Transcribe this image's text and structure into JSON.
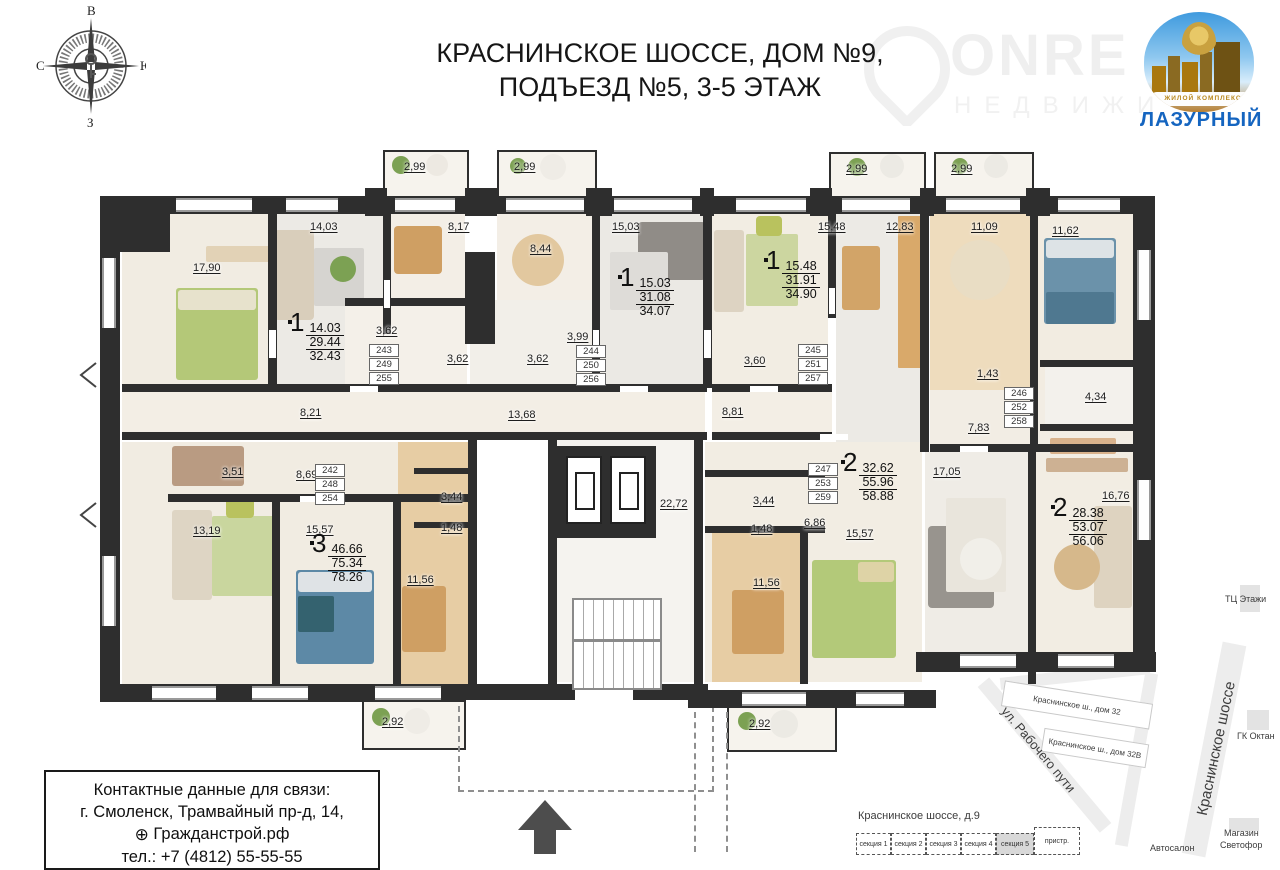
{
  "title": {
    "line1": "КРАСНИНСКОЕ ШОССЕ, ДОМ №9,",
    "line2": "ПОДЪЕЗД №5, 3-5 ЭТАЖ"
  },
  "compass": {
    "top": "В",
    "right": "Ю",
    "bottom": "З",
    "left": "С"
  },
  "branding": {
    "watermark_name": "ONRE",
    "watermark_sub": "НЕДВИЖИ",
    "complex_type": "ЖИЛОЙ КОМПЛЕКС",
    "complex_name": "ЛАЗУРНЫЙ"
  },
  "floorplan": {
    "room_labels": [
      {
        "text": "2,99",
        "x": 404,
        "y": 161
      },
      {
        "text": "2,99",
        "x": 514,
        "y": 161
      },
      {
        "text": "2,99",
        "x": 846,
        "y": 163
      },
      {
        "text": "2,99",
        "x": 951,
        "y": 163
      },
      {
        "text": "17,90",
        "x": 193,
        "y": 262
      },
      {
        "text": "14,03",
        "x": 310,
        "y": 221
      },
      {
        "text": "8,17",
        "x": 448,
        "y": 221
      },
      {
        "text": "8,44",
        "x": 530,
        "y": 243
      },
      {
        "text": "15,03",
        "x": 612,
        "y": 221
      },
      {
        "text": "15,48",
        "x": 818,
        "y": 221
      },
      {
        "text": "12,83",
        "x": 886,
        "y": 221
      },
      {
        "text": "11,09",
        "x": 971,
        "y": 221
      },
      {
        "text": "11,62",
        "x": 1052,
        "y": 225
      },
      {
        "text": "3,62",
        "x": 376,
        "y": 325
      },
      {
        "text": "3,62",
        "x": 447,
        "y": 353
      },
      {
        "text": "3,99",
        "x": 567,
        "y": 331
      },
      {
        "text": "3,62",
        "x": 527,
        "y": 353
      },
      {
        "text": "3,60",
        "x": 744,
        "y": 355
      },
      {
        "text": "1,43",
        "x": 977,
        "y": 368
      },
      {
        "text": "4,34",
        "x": 1085,
        "y": 391
      },
      {
        "text": "8,21",
        "x": 300,
        "y": 407
      },
      {
        "text": "13,68",
        "x": 508,
        "y": 409
      },
      {
        "text": "8,81",
        "x": 722,
        "y": 406
      },
      {
        "text": "7,83",
        "x": 968,
        "y": 422
      },
      {
        "text": "3,51",
        "x": 222,
        "y": 466
      },
      {
        "text": "8,69",
        "x": 296,
        "y": 469
      },
      {
        "text": "3,44",
        "x": 441,
        "y": 491
      },
      {
        "text": "1,48",
        "x": 441,
        "y": 522
      },
      {
        "text": "13,19",
        "x": 193,
        "y": 525
      },
      {
        "text": "15,57",
        "x": 306,
        "y": 524
      },
      {
        "text": "11,56",
        "x": 407,
        "y": 574
      },
      {
        "text": "22,72",
        "x": 660,
        "y": 498
      },
      {
        "text": "3,44",
        "x": 753,
        "y": 495
      },
      {
        "text": "1,48",
        "x": 751,
        "y": 523
      },
      {
        "text": "6,86",
        "x": 804,
        "y": 517
      },
      {
        "text": "11,56",
        "x": 753,
        "y": 577
      },
      {
        "text": "15,57",
        "x": 846,
        "y": 528
      },
      {
        "text": "17,05",
        "x": 933,
        "y": 466
      },
      {
        "text": "16,76",
        "x": 1102,
        "y": 490
      },
      {
        "text": "2,92",
        "x": 382,
        "y": 716
      },
      {
        "text": "2,92",
        "x": 749,
        "y": 718
      }
    ],
    "unit_stacks": [
      {
        "values": [
          "243",
          "249",
          "255"
        ],
        "x": 369,
        "y": 344
      },
      {
        "values": [
          "244",
          "250",
          "256"
        ],
        "x": 576,
        "y": 345
      },
      {
        "values": [
          "245",
          "251",
          "257"
        ],
        "x": 798,
        "y": 344
      },
      {
        "values": [
          "246",
          "252",
          "258"
        ],
        "x": 1004,
        "y": 387
      },
      {
        "values": [
          "242",
          "248",
          "254"
        ],
        "x": 315,
        "y": 464
      },
      {
        "values": [
          "247",
          "253",
          "259"
        ],
        "x": 808,
        "y": 463
      }
    ],
    "apartments": [
      {
        "type": "1",
        "areas": [
          "14.03",
          "29.44",
          "32.43"
        ],
        "x": 288,
        "y": 320
      },
      {
        "type": "1",
        "areas": [
          "15.03",
          "31.08",
          "34.07"
        ],
        "x": 618,
        "y": 275
      },
      {
        "type": "1",
        "areas": [
          "15.48",
          "31.91",
          "34.90"
        ],
        "x": 764,
        "y": 258
      },
      {
        "type": "2",
        "areas": [
          "32.62",
          "55.96",
          "58.88"
        ],
        "x": 841,
        "y": 460
      },
      {
        "type": "2",
        "areas": [
          "28.38",
          "53.07",
          "56.06"
        ],
        "x": 1051,
        "y": 505
      },
      {
        "type": "3",
        "areas": [
          "46.66",
          "75.34",
          "78.26"
        ],
        "x": 310,
        "y": 541
      }
    ]
  },
  "contact": {
    "line1": "Контактные данные для связи:",
    "line2": "г. Смоленск, Трамвайный пр-д, 14,",
    "site": "Гражданстрой.рф",
    "phone": "тел.: +7 (4812) 55-55-55"
  },
  "map": {
    "labels": [
      {
        "text": "ул. Рабочего пути",
        "x": 985,
        "y": 742,
        "rot": 50,
        "size": 13,
        "bold": false
      },
      {
        "text": "Краснинское шоссе",
        "x": 1148,
        "y": 740,
        "rot": -78,
        "size": 15,
        "bold": false
      },
      {
        "text": "ГК Октан",
        "x": 1237,
        "y": 731,
        "rot": 0,
        "size": 9,
        "bold": false
      },
      {
        "text": "ТЦ Этажи",
        "x": 1225,
        "y": 594,
        "rot": 0,
        "size": 9,
        "bold": false
      },
      {
        "text": "Магазин",
        "x": 1224,
        "y": 828,
        "rot": 0,
        "size": 9,
        "bold": false
      },
      {
        "text": "Светофор",
        "x": 1220,
        "y": 840,
        "rot": 0,
        "size": 9,
        "bold": false
      },
      {
        "text": "Автосалон",
        "x": 1150,
        "y": 843,
        "rot": 0,
        "size": 9,
        "bold": false
      },
      {
        "text": "Краснинское шоссе, д.9",
        "x": 858,
        "y": 810,
        "rot": 0,
        "size": 11,
        "bold": false
      }
    ],
    "buildings": [
      {
        "text": "Краснинское ш., дом 32",
        "x": 1002,
        "y": 692,
        "w": 148,
        "h": 24,
        "rot": 9
      },
      {
        "text": "Краснинское ш., дом 32В",
        "x": 1042,
        "y": 736,
        "w": 104,
        "h": 22,
        "rot": 9
      }
    ],
    "sections": [
      "секция 1",
      "секция 2",
      "секция 3",
      "секция 4",
      "секция 5",
      "пристр."
    ]
  }
}
